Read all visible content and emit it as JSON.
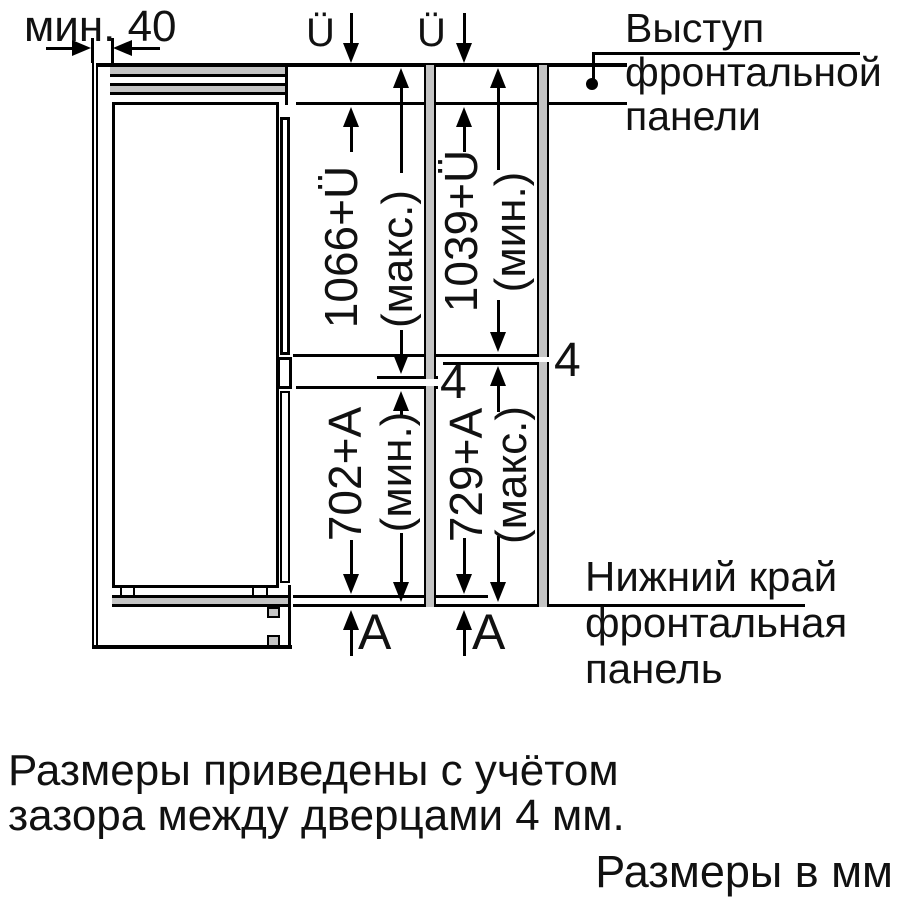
{
  "figure": {
    "min_gap_label": "мин. 40",
    "overhang_symbol_left": "Ü",
    "overhang_symbol_right": "Ü",
    "top_callout": {
      "line1": "Выступ",
      "line2": "фронтальной",
      "line3": "панели"
    },
    "left_column": {
      "upper_dim": "1066+Ü",
      "upper_qual": "(макс.)",
      "gap": "4",
      "lower_dim": "702+A",
      "lower_qual": "(мин.)",
      "bottom_symbol": "A"
    },
    "right_column": {
      "upper_dim": "1039+Ü",
      "upper_qual": "(мин.)",
      "gap": "4",
      "lower_dim": "729+A",
      "lower_qual": "(макс.)",
      "bottom_symbol": "A"
    },
    "bottom_callout": {
      "line1": "Нижний край",
      "line2": "фронтальная",
      "line3": "панель"
    }
  },
  "notes": {
    "note_line1": "Размеры приведены с учётом",
    "note_line2": "зазора между дверцами 4 мм.",
    "units": "Размеры в мм"
  },
  "colors": {
    "line": "#000000",
    "panel_fill": "#c4c4c4",
    "text": "#111111"
  }
}
